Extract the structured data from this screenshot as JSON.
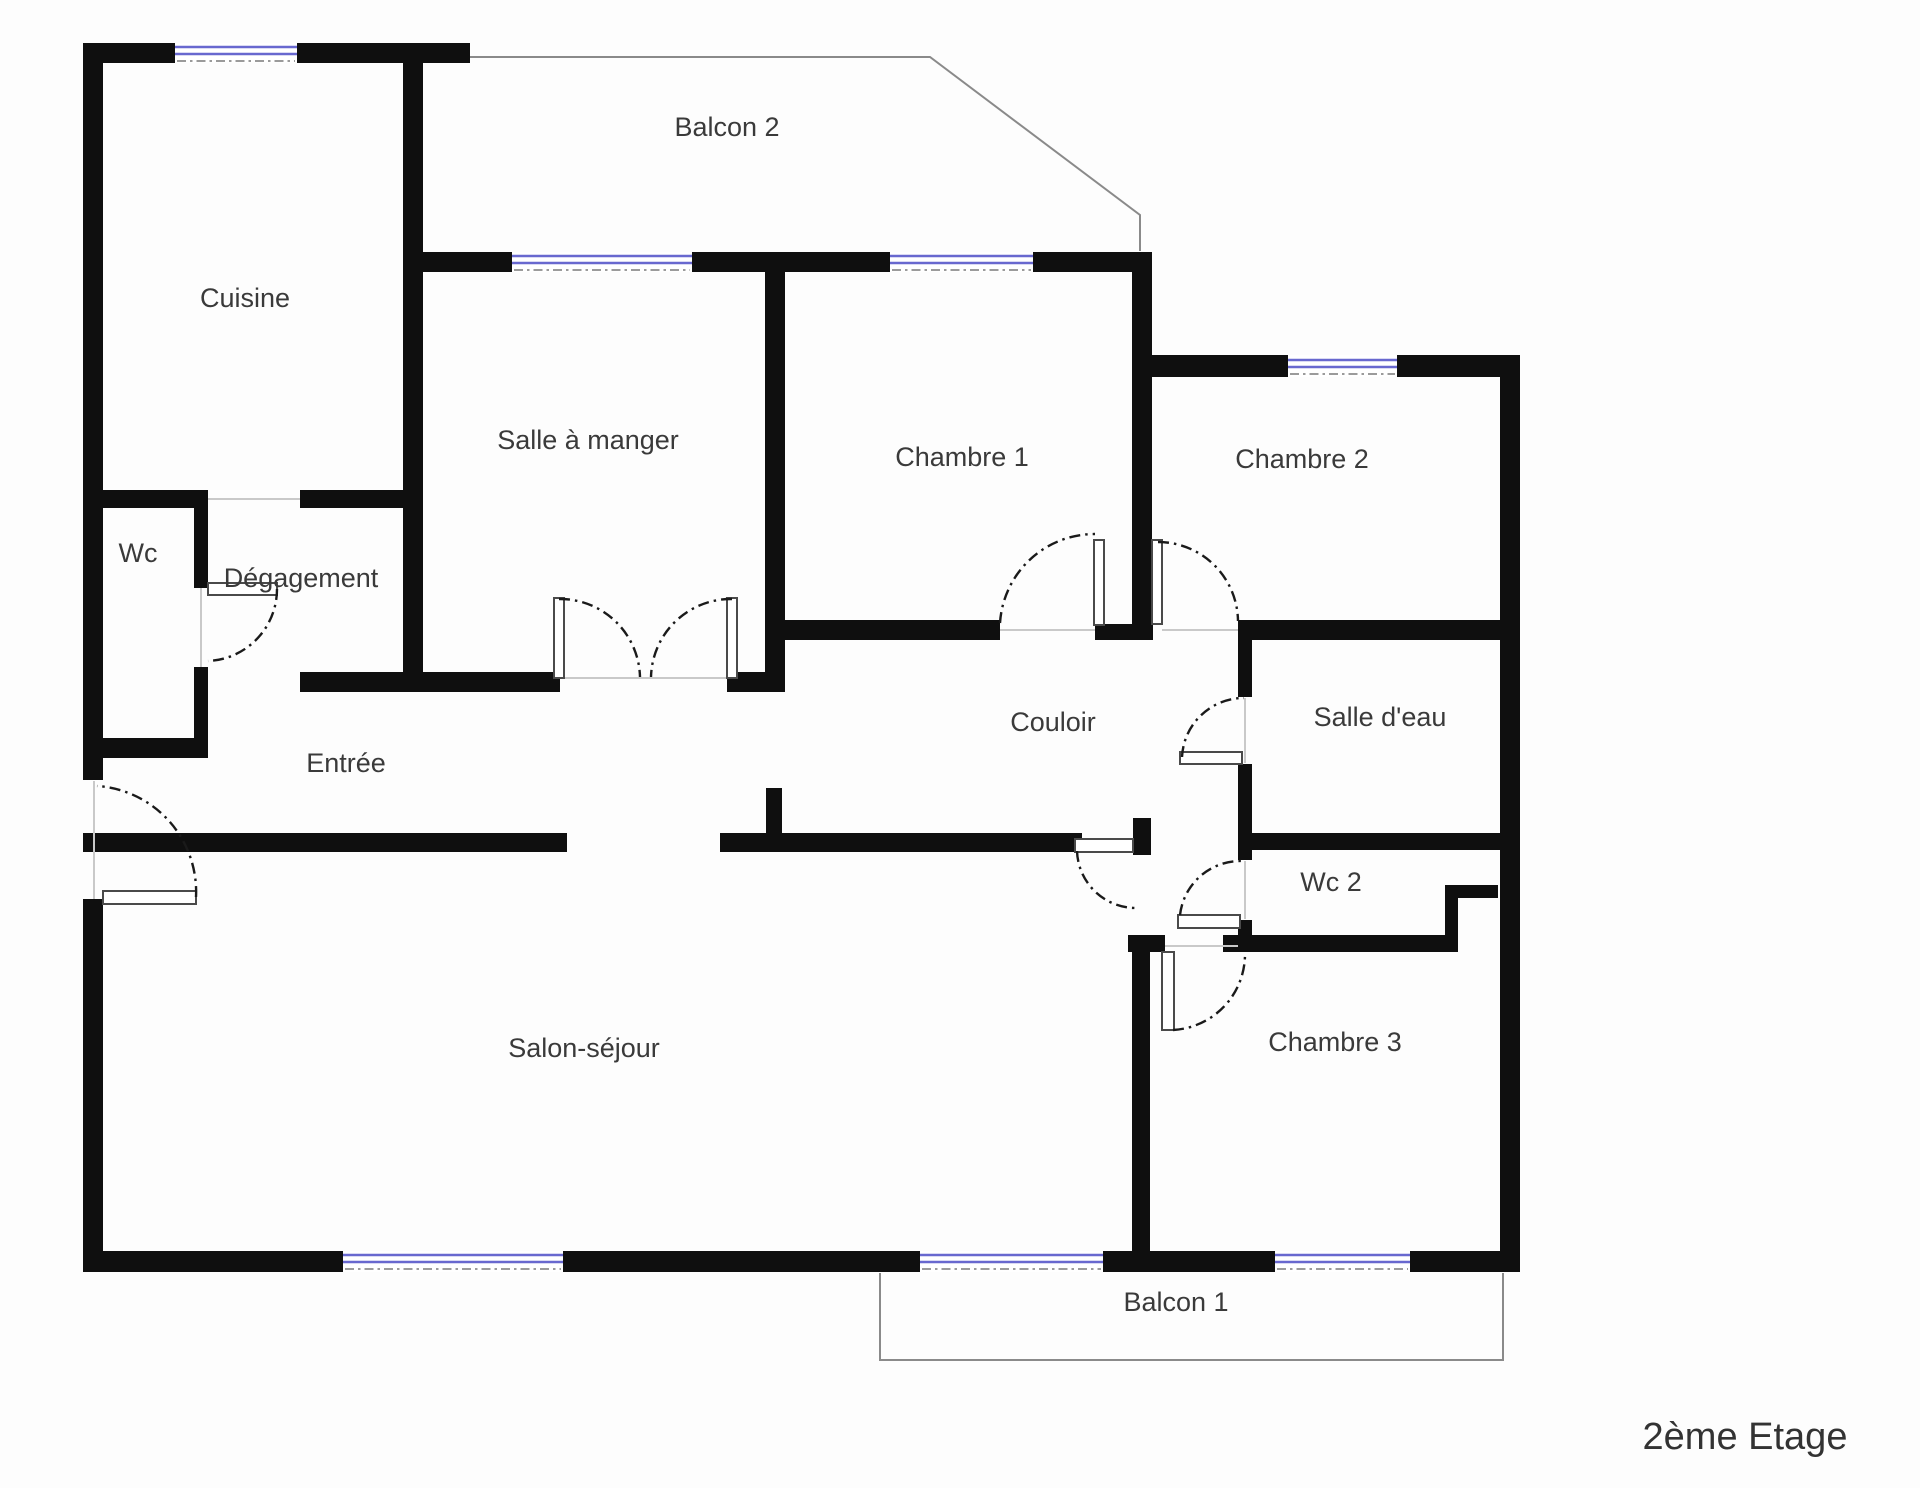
{
  "floor_label": "2ème Etage",
  "rooms": [
    {
      "label": "Cuisine"
    },
    {
      "label": "Salle à manger"
    },
    {
      "label": "Chambre 1"
    },
    {
      "label": "Chambre 2"
    },
    {
      "label": "Wc"
    },
    {
      "label": "Dégagement"
    },
    {
      "label": "Entrée"
    },
    {
      "label": "Couloir"
    },
    {
      "label": "Salle d'eau"
    },
    {
      "label": "Wc 2"
    },
    {
      "label": "Salon-séjour"
    },
    {
      "label": "Chambre 3"
    }
  ],
  "balconies": [
    {
      "label": "Balcon 2"
    },
    {
      "label": "Balcon 1"
    }
  ],
  "colors": {
    "bg": "#fdfdfd",
    "wall": "#0f0f0f",
    "glass": "#6868cf",
    "leaf": "#4a4a4a",
    "arc": "#1a1a1a",
    "bal": "#8a8a8a",
    "text": "#3a3a3a"
  }
}
